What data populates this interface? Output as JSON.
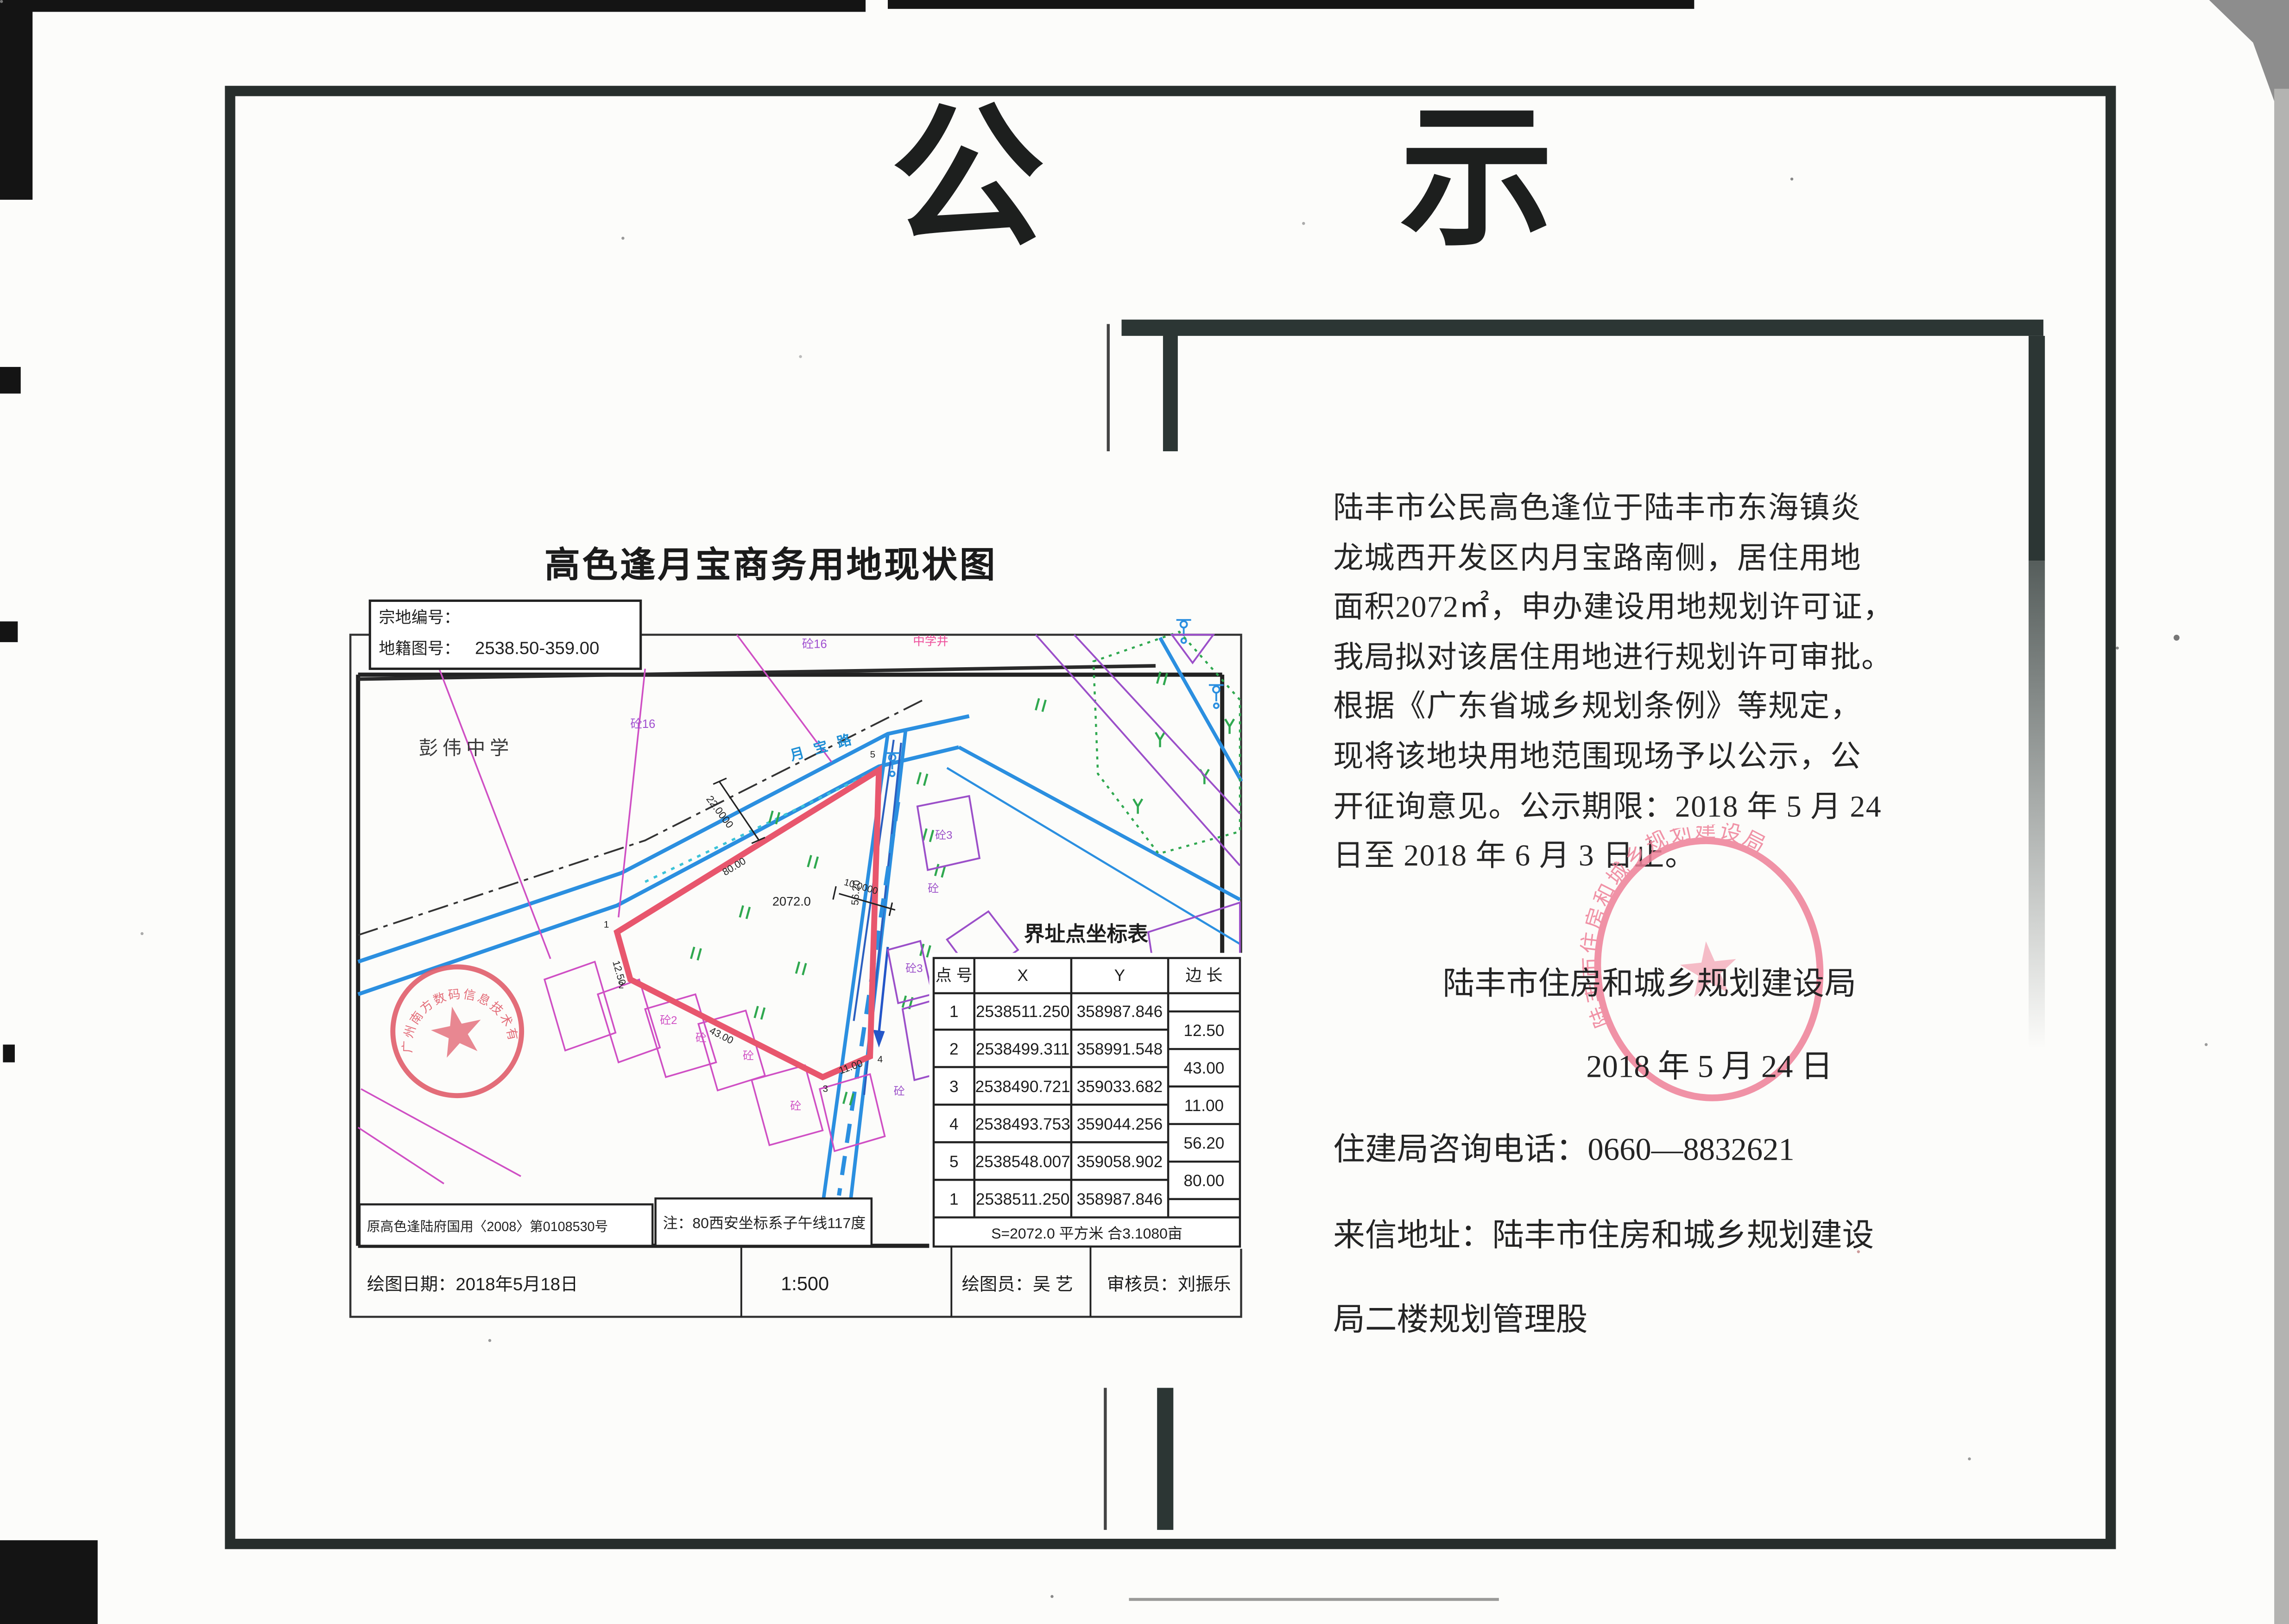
{
  "page_title": {
    "char1": "公",
    "char2": "示"
  },
  "map": {
    "title": "高色逢月宝商务用地现状图",
    "info_box": {
      "line1": "宗地编号：",
      "line2_label": "地籍图号：",
      "line2_value": "2538.50-359.00"
    },
    "labels": {
      "school": "彭伟中学",
      "road": "月宝路",
      "well": "中学井",
      "con16_a": "砼16",
      "con16_b": "砼16",
      "area": "2072.0",
      "dim_a": "22.0000",
      "dim_b": "10.0000",
      "plots": [
        "砼3",
        "砼",
        "砼3",
        "砼",
        "砼2",
        "砼",
        "砼",
        "砼"
      ]
    },
    "vertices": [
      "1",
      "2",
      "3",
      "4",
      "5"
    ],
    "edge_labels": [
      "80.00",
      "12.50",
      "43.00",
      "11.00",
      "56.20"
    ],
    "cert_box": "原高色逢陆府国用〈2008〉第0108530号",
    "note_box": "注：80西安坐标系子午线117度",
    "table": {
      "title": "界址点坐标表",
      "headers": [
        "点 号",
        "X",
        "Y",
        "边 长"
      ],
      "rows": [
        {
          "n": "1",
          "x": "2538511.250",
          "y": "358987.846"
        },
        {
          "n": "2",
          "x": "2538499.311",
          "y": "358991.548"
        },
        {
          "n": "3",
          "x": "2538490.721",
          "y": "359033.682"
        },
        {
          "n": "4",
          "x": "2538493.753",
          "y": "359044.256"
        },
        {
          "n": "5",
          "x": "2538548.007",
          "y": "359058.902"
        },
        {
          "n": "1",
          "x": "2538511.250",
          "y": "358987.846"
        }
      ],
      "edges": [
        "12.50",
        "43.00",
        "11.00",
        "56.20",
        "80.00"
      ],
      "footer": "S=2072.0 平方米 合3.1080亩"
    },
    "strip": {
      "date": "绘图日期：2018年5月18日",
      "scale": "1:500",
      "drafter": "绘图员：吴 艺",
      "checker": "审核员：刘振乐"
    },
    "stamp_ring": "广州南方数码信息技术有限公司"
  },
  "notice": {
    "lines": [
      "陆丰市公民高色逢位于陆丰市东海镇炎",
      "龙城西开发区内月宝路南侧，居住用地",
      "面积2072㎡，申办建设用地规划许可证，",
      "我局拟对该居住用地进行规划许可审批。",
      "根据《广东省城乡规划条例》等规定，",
      "现将该地块用地范围现场予以公示，公",
      "开征询意见。公示期限：2018 年 5 月 24",
      "日至 2018 年 6 月 3 日止。"
    ]
  },
  "signature": {
    "agency": "陆丰市住房和城乡规划建设局",
    "date": "2018 年 5 月 24 日",
    "phone": "住建局咨询电话：0660—8832621",
    "address1": "来信地址：陆丰市住房和城乡规划建设",
    "address2": "局二楼规划管理股",
    "stamp_ring": "陆丰市住房和城乡规划建设局"
  },
  "colors": {
    "frame": "#272e2c",
    "road_blue": "#2b8fe0",
    "navy": "#2b5fc0",
    "parcel_red": "#e8566d",
    "magenta": "#cf4fc4",
    "purple": "#9b4fc9",
    "green": "#2fa84f",
    "cyan": "#3bc3d8",
    "pink": "#ee4f9b",
    "stamp_red": "#e05a68"
  }
}
